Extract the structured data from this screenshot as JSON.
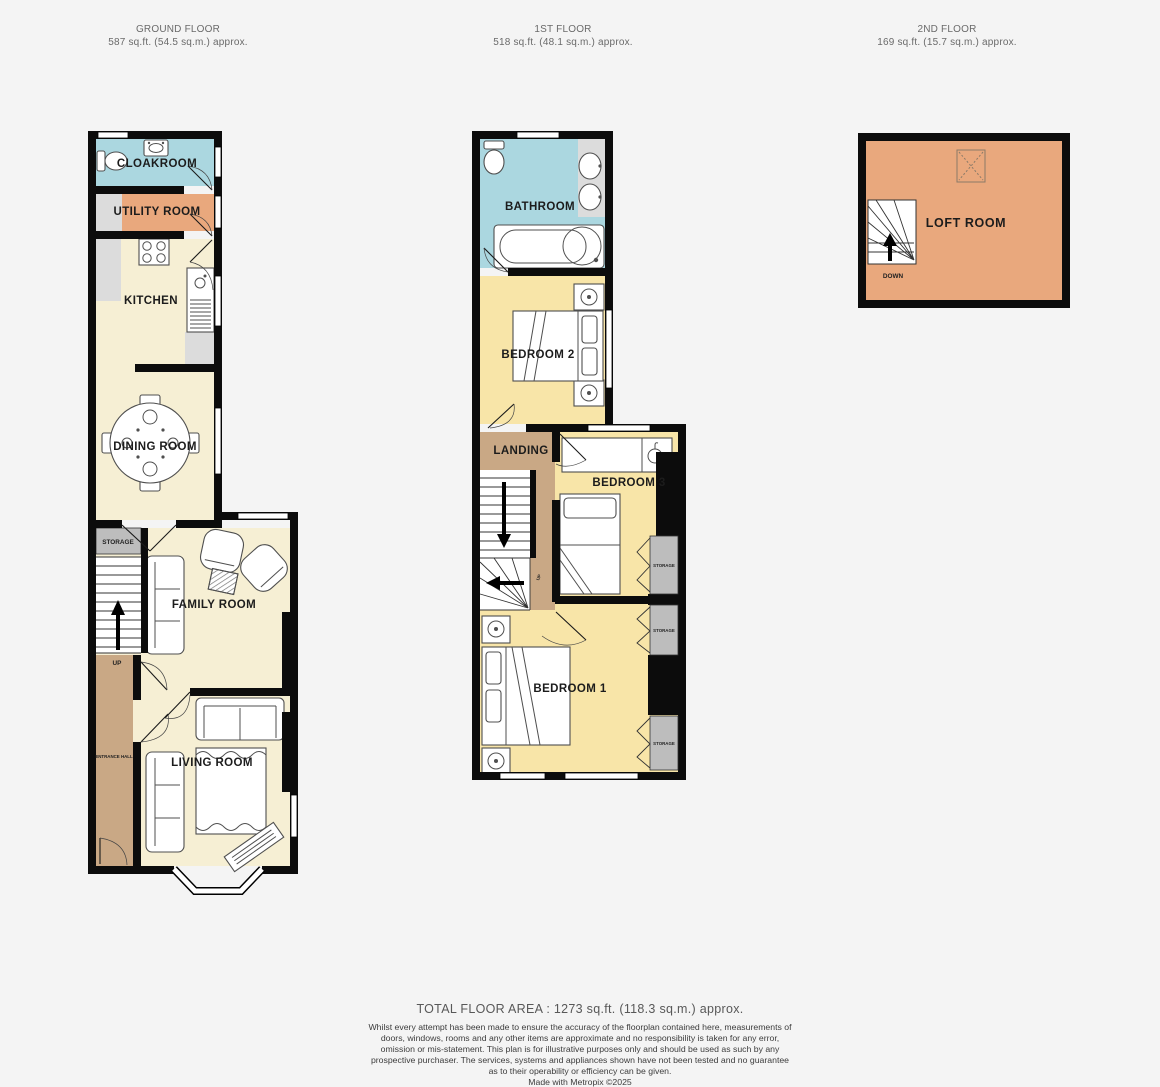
{
  "colors": {
    "wall": "#0c0c0c",
    "cream": "#f6efd4",
    "yellow": "#f8e5a8",
    "blue": "#abd7e0",
    "orange": "#e9a87d",
    "tan": "#c9a885",
    "storageGray": "#bdbdbd",
    "applianceGray": "#dcdcdc"
  },
  "floors": [
    {
      "name": "GROUND FLOOR",
      "area": "587 sq.ft. (54.5 sq.m.) approx."
    },
    {
      "name": "1ST FLOOR",
      "area": "518 sq.ft. (48.1 sq.m.) approx."
    },
    {
      "name": "2ND FLOOR",
      "area": "169 sq.ft. (15.7 sq.m.) approx."
    }
  ],
  "ground": {
    "cloakroom": "CLOAKROOM",
    "utility_room": "UTILITY ROOM",
    "kitchen": "KITCHEN",
    "dining_room": "DINING ROOM",
    "storage": "STORAGE",
    "family_room": "FAMILY ROOM",
    "living_room": "LIVING ROOM",
    "entrance_hall": "ENTRANCE HALL",
    "up": "UP"
  },
  "first": {
    "bathroom": "BATHROOM",
    "bedroom2": "BEDROOM 2",
    "landing": "LANDING",
    "bedroom3": "BEDROOM 3",
    "bedroom1": "BEDROOM 1",
    "storage": "STORAGE",
    "up": "UP"
  },
  "second": {
    "loft_room": "LOFT ROOM",
    "down": "DOWN"
  },
  "footer": {
    "total_area": "TOTAL FLOOR AREA : 1273 sq.ft. (118.3 sq.m.) approx.",
    "disclaimer": "Whilst every attempt has been made to ensure the accuracy of the floorplan contained here, measurements of doors, windows, rooms and any other items are approximate and no responsibility is taken for any error, omission or mis-statement. This plan is for illustrative purposes only and should be used as such by any prospective purchaser. The services, systems and appliances shown have not been tested and no guarantee as to their operability or efficiency can be given.",
    "credit": "Made with Metropix ©2025"
  }
}
